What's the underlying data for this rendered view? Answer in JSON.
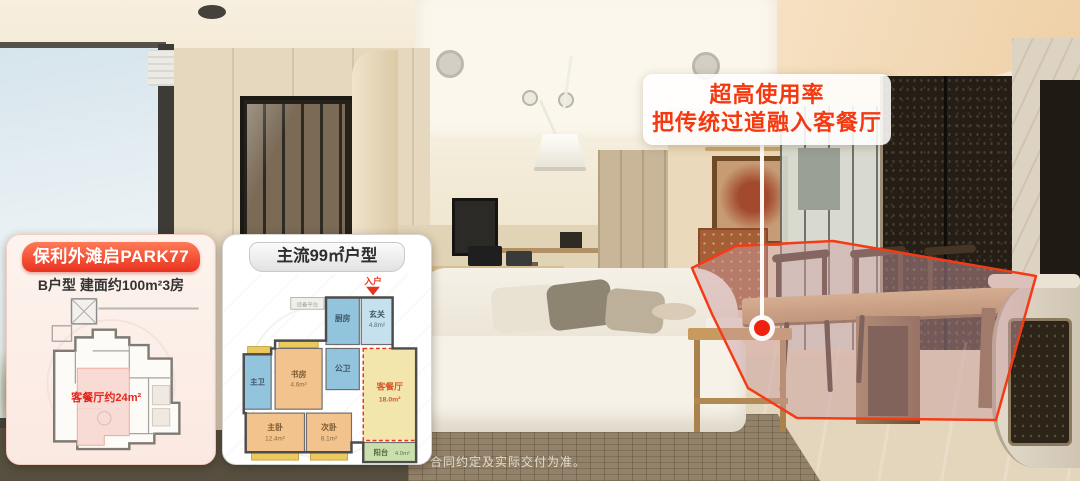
{
  "callout": {
    "line1": "超高使用率",
    "line2": "把传统过道融入客餐厅",
    "text_color": "#f5380f"
  },
  "project_card": {
    "title": "保利外滩启PARK77",
    "subtitle": "B户型 建面约100m²3房",
    "plan": {
      "highlight_label": "客餐厅约24m²",
      "highlight_color": "#f7d8d1",
      "label_color": "#e2261b"
    }
  },
  "mainstream_card": {
    "title": "主流99㎡户型",
    "plan": {
      "entry_label": "入户",
      "equipment_label": "设备平台",
      "rooms": {
        "kitchen": {
          "name": "厨房"
        },
        "entry_hall": {
          "name": "玄关",
          "area": "4.8m²"
        },
        "guest_bath": {
          "name": "公卫"
        },
        "study": {
          "name": "书房",
          "area": "4.6m²"
        },
        "master_bath": {
          "name": "主卫"
        },
        "master_bedroom": {
          "name": "主卧",
          "area": "12.4m²"
        },
        "second_bedroom": {
          "name": "次卧",
          "area": "8.1m²"
        },
        "living_dining": {
          "name": "客餐厅",
          "area": "18.0m²"
        },
        "balcony": {
          "name": "阳台",
          "area": "4.0m²"
        }
      }
    }
  },
  "disclaimer": {
    "text": "合同约定及实际交付为准。"
  },
  "colors": {
    "accent_red": "#f43b17",
    "card_header_gradient": [
      "#ff7a57",
      "#e9321f"
    ],
    "highlight_fill": "rgba(203,156,160,0.48)",
    "room_blue": "#92c4de",
    "room_light_blue": "#c6e1ee",
    "room_orange": "#f2c38c",
    "room_yellow": "#f3e6ad",
    "room_green": "#cadfad",
    "bay_window_yellow": "#ecc95c"
  }
}
